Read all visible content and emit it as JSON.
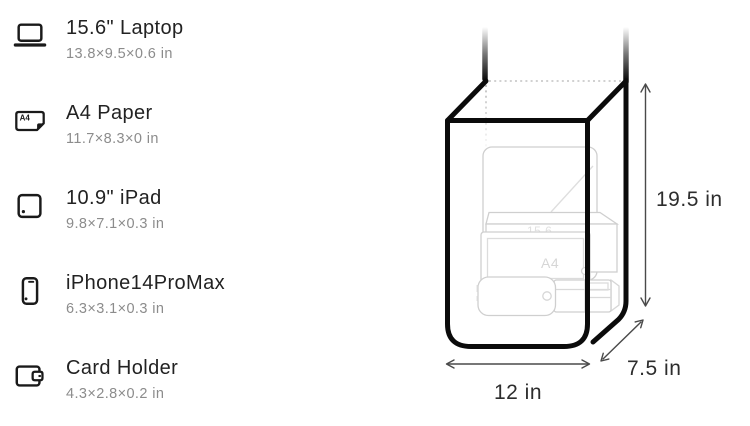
{
  "item_list": {
    "items": [
      {
        "name": "15.6\" Laptop",
        "dimensions": "13.8×9.5×0.6 in",
        "icon": "laptop-icon"
      },
      {
        "name": "A4 Paper",
        "dimensions": "11.7×8.3×0 in",
        "icon": "a4-paper-icon"
      },
      {
        "name": "10.9\" iPad",
        "dimensions": "9.8×7.1×0.3 in",
        "icon": "ipad-icon"
      },
      {
        "name": "iPhone14ProMax",
        "dimensions": "6.3×3.1×0.3 in",
        "icon": "iphone-icon"
      },
      {
        "name": "Card Holder",
        "dimensions": "4.3×2.8×0.2 in",
        "icon": "wallet-icon"
      }
    ]
  },
  "icon_labels": {
    "a4_badge": "A4"
  },
  "diagram": {
    "bag": {
      "height_label": "19.5 in",
      "depth_label": "7.5 in",
      "width_label": "12 in"
    },
    "ghost_items": {
      "laptop_label": "15.6",
      "a4_label": "A4"
    }
  },
  "colors": {
    "bag_outline": "#0b0b0b",
    "item_title": "#222222",
    "item_dimensions": "#8c8c8c",
    "ghost_item_outline": "#cfcfcf",
    "dimension_arrow": "#4a4a4a",
    "dimension_label": "#2d2d2d"
  }
}
